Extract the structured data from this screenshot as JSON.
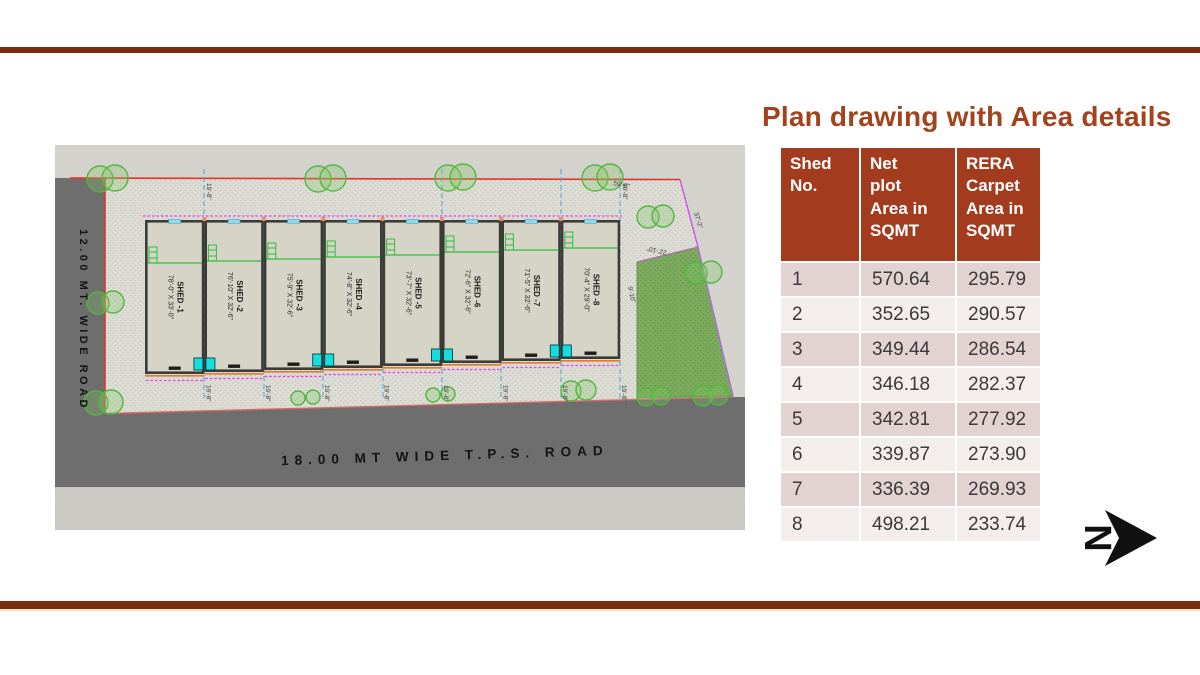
{
  "slide": {
    "title": "Plan drawing with Area details",
    "north_label": "N"
  },
  "colors": {
    "accent_bar": "#7B2B10",
    "title": "#A2431D",
    "table_header_bg": "#A33B1E",
    "table_row_odd": "#E2D2D2",
    "table_row_even": "#F3EDEC",
    "table_text": "#3A3A3A",
    "plan_bg": "#D3D2CC",
    "plot_fill": "#DCDBD4",
    "road": "#6E6E6E",
    "road_strip": "#CAC9C3",
    "boundary_red": "#E63228",
    "dashed_blue": "#44A8DD",
    "magenta": "#EE3CEE",
    "green": "#2FBF3A",
    "garden": "#7CAB5E",
    "cyan_box": "#17DEDE",
    "shed_fill": "#D6D4C6",
    "wall": "#3B3B38",
    "orange": "#E07B30"
  },
  "table": {
    "headers": [
      "Shed\nNo.",
      "Net\nplot\nArea in\nSQMT",
      "RERA\nCarpet\nArea in\nSQMT"
    ],
    "rows": [
      {
        "shed_no": "1",
        "net_plot": "570.64",
        "rera_carpet": "295.79"
      },
      {
        "shed_no": "2",
        "net_plot": "352.65",
        "rera_carpet": "290.57"
      },
      {
        "shed_no": "3",
        "net_plot": "349.44",
        "rera_carpet": "286.54"
      },
      {
        "shed_no": "4",
        "net_plot": "346.18",
        "rera_carpet": "282.37"
      },
      {
        "shed_no": "5",
        "net_plot": "342.81",
        "rera_carpet": "277.92"
      },
      {
        "shed_no": "6",
        "net_plot": "339.87",
        "rera_carpet": "273.90"
      },
      {
        "shed_no": "7",
        "net_plot": "336.39",
        "rera_carpet": "269.93"
      },
      {
        "shed_no": "8",
        "net_plot": "498.21",
        "rera_carpet": "233.74"
      }
    ]
  },
  "plan": {
    "left_road_label": "12.00 MT. WIDE ROAD",
    "bottom_road_label": "18.00 MT WIDE T.P.S. ROAD",
    "sheds": [
      {
        "name": "SHED -1",
        "dims": "78'-0\" X 33'-0\""
      },
      {
        "name": "SHED -2",
        "dims": "76'-10\" X 32'-6\""
      },
      {
        "name": "SHED -3",
        "dims": "75'-9\" X 32'-6\""
      },
      {
        "name": "SHED -4",
        "dims": "74'-8\" X 32'-6\""
      },
      {
        "name": "SHED -5",
        "dims": "73'-7\" X 32'-6\""
      },
      {
        "name": "SHED -6",
        "dims": "72'-6\" X 32'-6\""
      },
      {
        "name": "SHED -7",
        "dims": "71'-5\" X 32'-6\""
      },
      {
        "name": "SHED -8",
        "dims": "70'-4\" X 29'-0\""
      }
    ],
    "dimensions": {
      "top_width": "59'-8\"",
      "right_slant": "37'-2\"",
      "right_lower": "22'-10\"",
      "garden_side": "9'-10\"",
      "shed_width": "19'-8\""
    }
  }
}
